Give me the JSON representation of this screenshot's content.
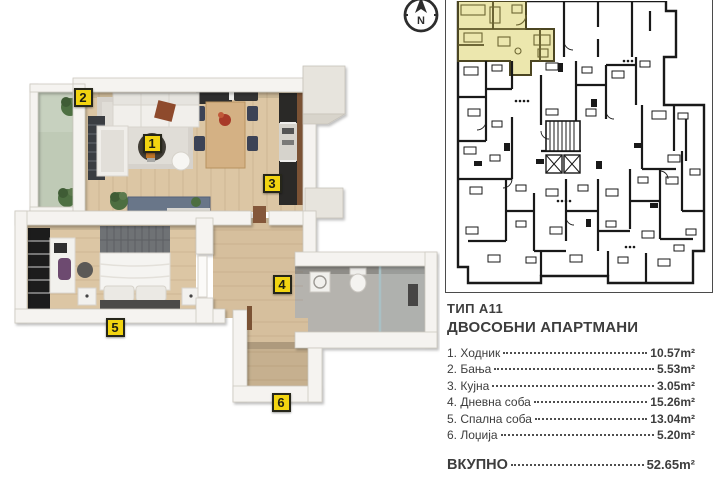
{
  "colors": {
    "accent-yellow": "#f2d410",
    "highlight-yellow": "#ece7ae",
    "ink": "#3d3d3d",
    "plan-line": "#191919",
    "wood": "#dcc6a4",
    "wood-dark": "#c6b08f",
    "balcony-green": "#bfcab6",
    "bath-gray": "#b5b3ae",
    "wall": "#f5f3f0"
  },
  "compass": {
    "label": "N"
  },
  "unit_plan": {
    "badges": [
      "1",
      "2",
      "3",
      "4",
      "5",
      "6"
    ]
  },
  "info": {
    "type_label": "ТИП А11",
    "subtitle": "ДВОСОБНИ АПАРТМАНИ",
    "rooms": [
      {
        "name": "1. Ходник",
        "area": "10.57m²"
      },
      {
        "name": "2. Бања",
        "area": "5.53m²"
      },
      {
        "name": "3. Кујна",
        "area": "3.05m²"
      },
      {
        "name": "4. Дневна соба",
        "area": "15.26m²"
      },
      {
        "name": "5. Спална соба",
        "area": "13.04m²"
      },
      {
        "name": "6. Лоџија",
        "area": "5.20m²"
      }
    ],
    "total_label": "ВКУПНО",
    "total_area": "52.65m²"
  }
}
